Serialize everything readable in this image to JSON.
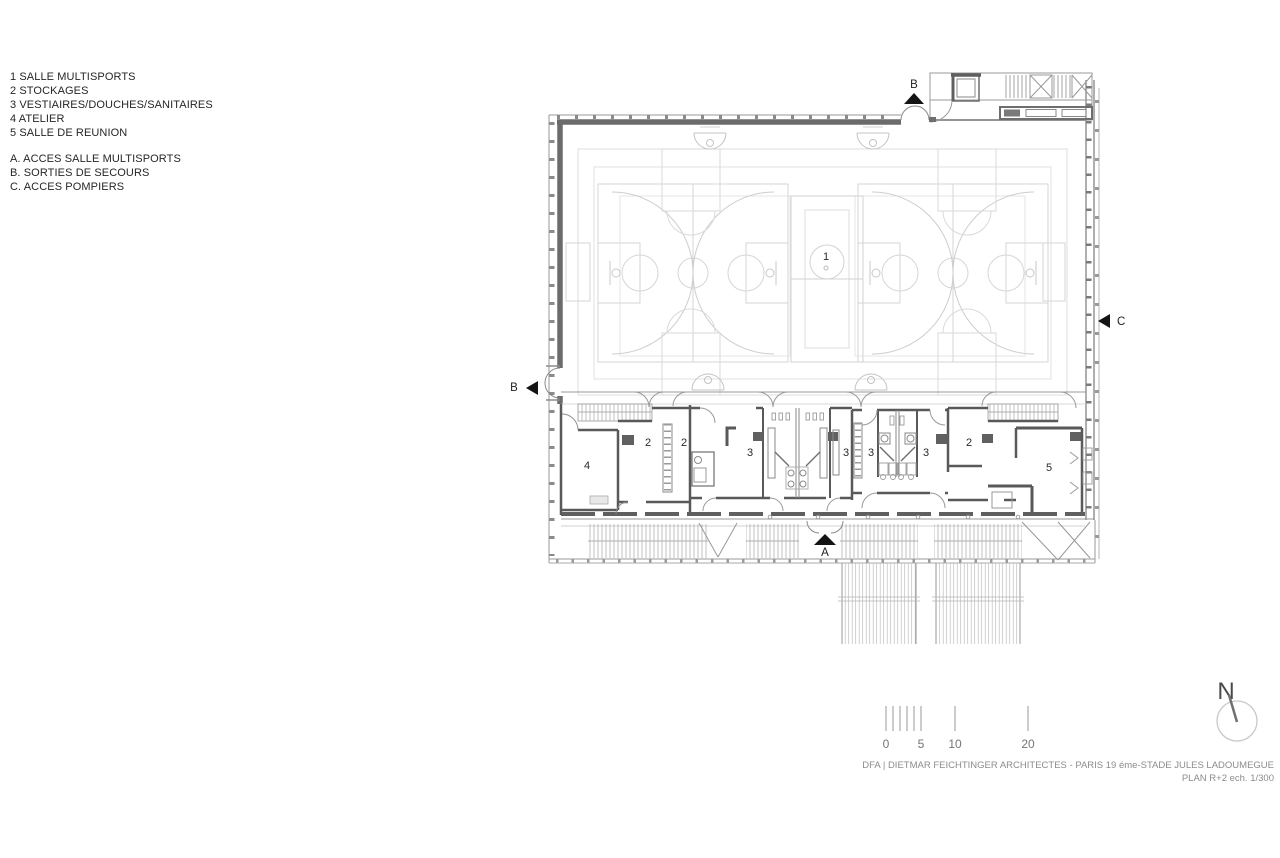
{
  "legend": {
    "room_items": [
      "1 SALLE MULTISPORTS",
      "2 STOCKAGES",
      "3 VESTIAIRES/DOUCHES/SANITAIRES",
      "4 ATELIER",
      "5 SALLE DE REUNION"
    ],
    "access_items": [
      "A. ACCES SALLE MULTISPORTS",
      "B. SORTIES DE SECOURS",
      "C. ACCES POMPIERS"
    ]
  },
  "plan": {
    "hall_label": "1",
    "room_labels": [
      {
        "room": "atelier",
        "label": "4"
      },
      {
        "room": "stockage-left-a",
        "label": "2"
      },
      {
        "room": "stockage-left-b",
        "label": "2"
      },
      {
        "room": "vestiaire-1",
        "label": "3"
      },
      {
        "room": "vestiaire-2",
        "label": "3"
      },
      {
        "room": "vestiaire-3",
        "label": "3"
      },
      {
        "room": "vestiaire-4",
        "label": "3"
      },
      {
        "room": "stockage-right",
        "label": "2"
      },
      {
        "room": "salle-de-reunion",
        "label": "5"
      }
    ],
    "markers": {
      "b_top": "B",
      "b_left": "B",
      "c_right": "C",
      "a_bottom": "A"
    }
  },
  "scale_bar": {
    "tick_labels": [
      "0",
      "5",
      "10",
      "20"
    ]
  },
  "north_arrow": {
    "label": "N"
  },
  "title_block": {
    "line1": "DFA | DIETMAR FEICHTINGER ARCHITECTES - PARIS 19 éme-STADE JULES LADOUMEGUE",
    "line2": "PLAN R+2 ech. 1/300"
  },
  "colors": {
    "wall": "#5f5f5f",
    "wall_thick": "#6b6b6b",
    "line_light": "#d8d8d8",
    "hatch": "#b0b0b0",
    "text_dark": "#2a2a2a",
    "text_gray": "#8c8c8c"
  }
}
